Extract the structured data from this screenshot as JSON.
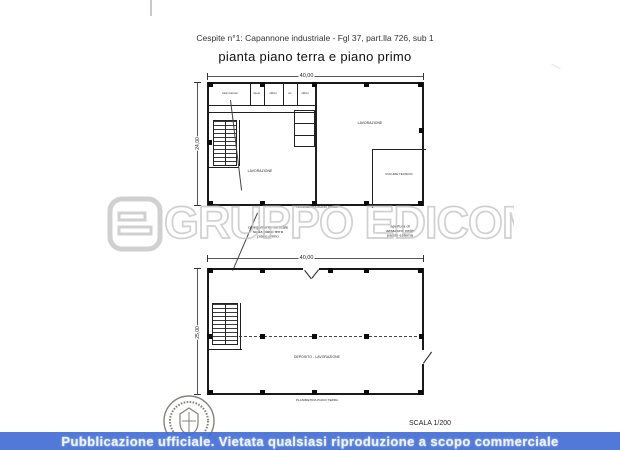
{
  "header": {
    "line1": "Cespite n°1:  Capannone industriale - Fgl 37, part.lla 726, sub 1",
    "title": "pianta piano terra e piano primo"
  },
  "upper_plan": {
    "dim_top": "40,00",
    "dim_left": "24,00",
    "office_rooms": [
      "sala riunioni",
      "ripost.",
      "ufficio",
      "wc",
      "ufficio"
    ],
    "zone_left": "LAVORAZIONE",
    "zone_right": "LAVORAZIONE",
    "room_volume": "VOLUME TECNICO",
    "caption": "PLANIMETRIA PIANO PRIMO"
  },
  "lower_plan": {
    "dim_top": "40,00",
    "dim_left": "25,00",
    "zone": "DEPOSITO - LAVORAZIONE",
    "caption": "PLANIMETRIA PIANO TERRA"
  },
  "annotations": {
    "block_a": [
      "collegamento verticale",
      "scala piano terra",
      "piano primo"
    ],
    "block_b": [
      "apertura di",
      "aerazione nella",
      "parete esterna"
    ]
  },
  "watermark": {
    "text": "GRUPPO EDICOM",
    "logo": "edicom-logo"
  },
  "scale_label": "SCALA 1/200",
  "footer": {
    "text": "Pubblicazione ufficiale. Vietata qualsiasi riproduzione a scopo commerciale",
    "bg": "#4273d8",
    "text_color": "#edf3ff"
  },
  "colors": {
    "plan_line": "#1f1f1f",
    "watermark_gray": "#c8c8c8"
  }
}
